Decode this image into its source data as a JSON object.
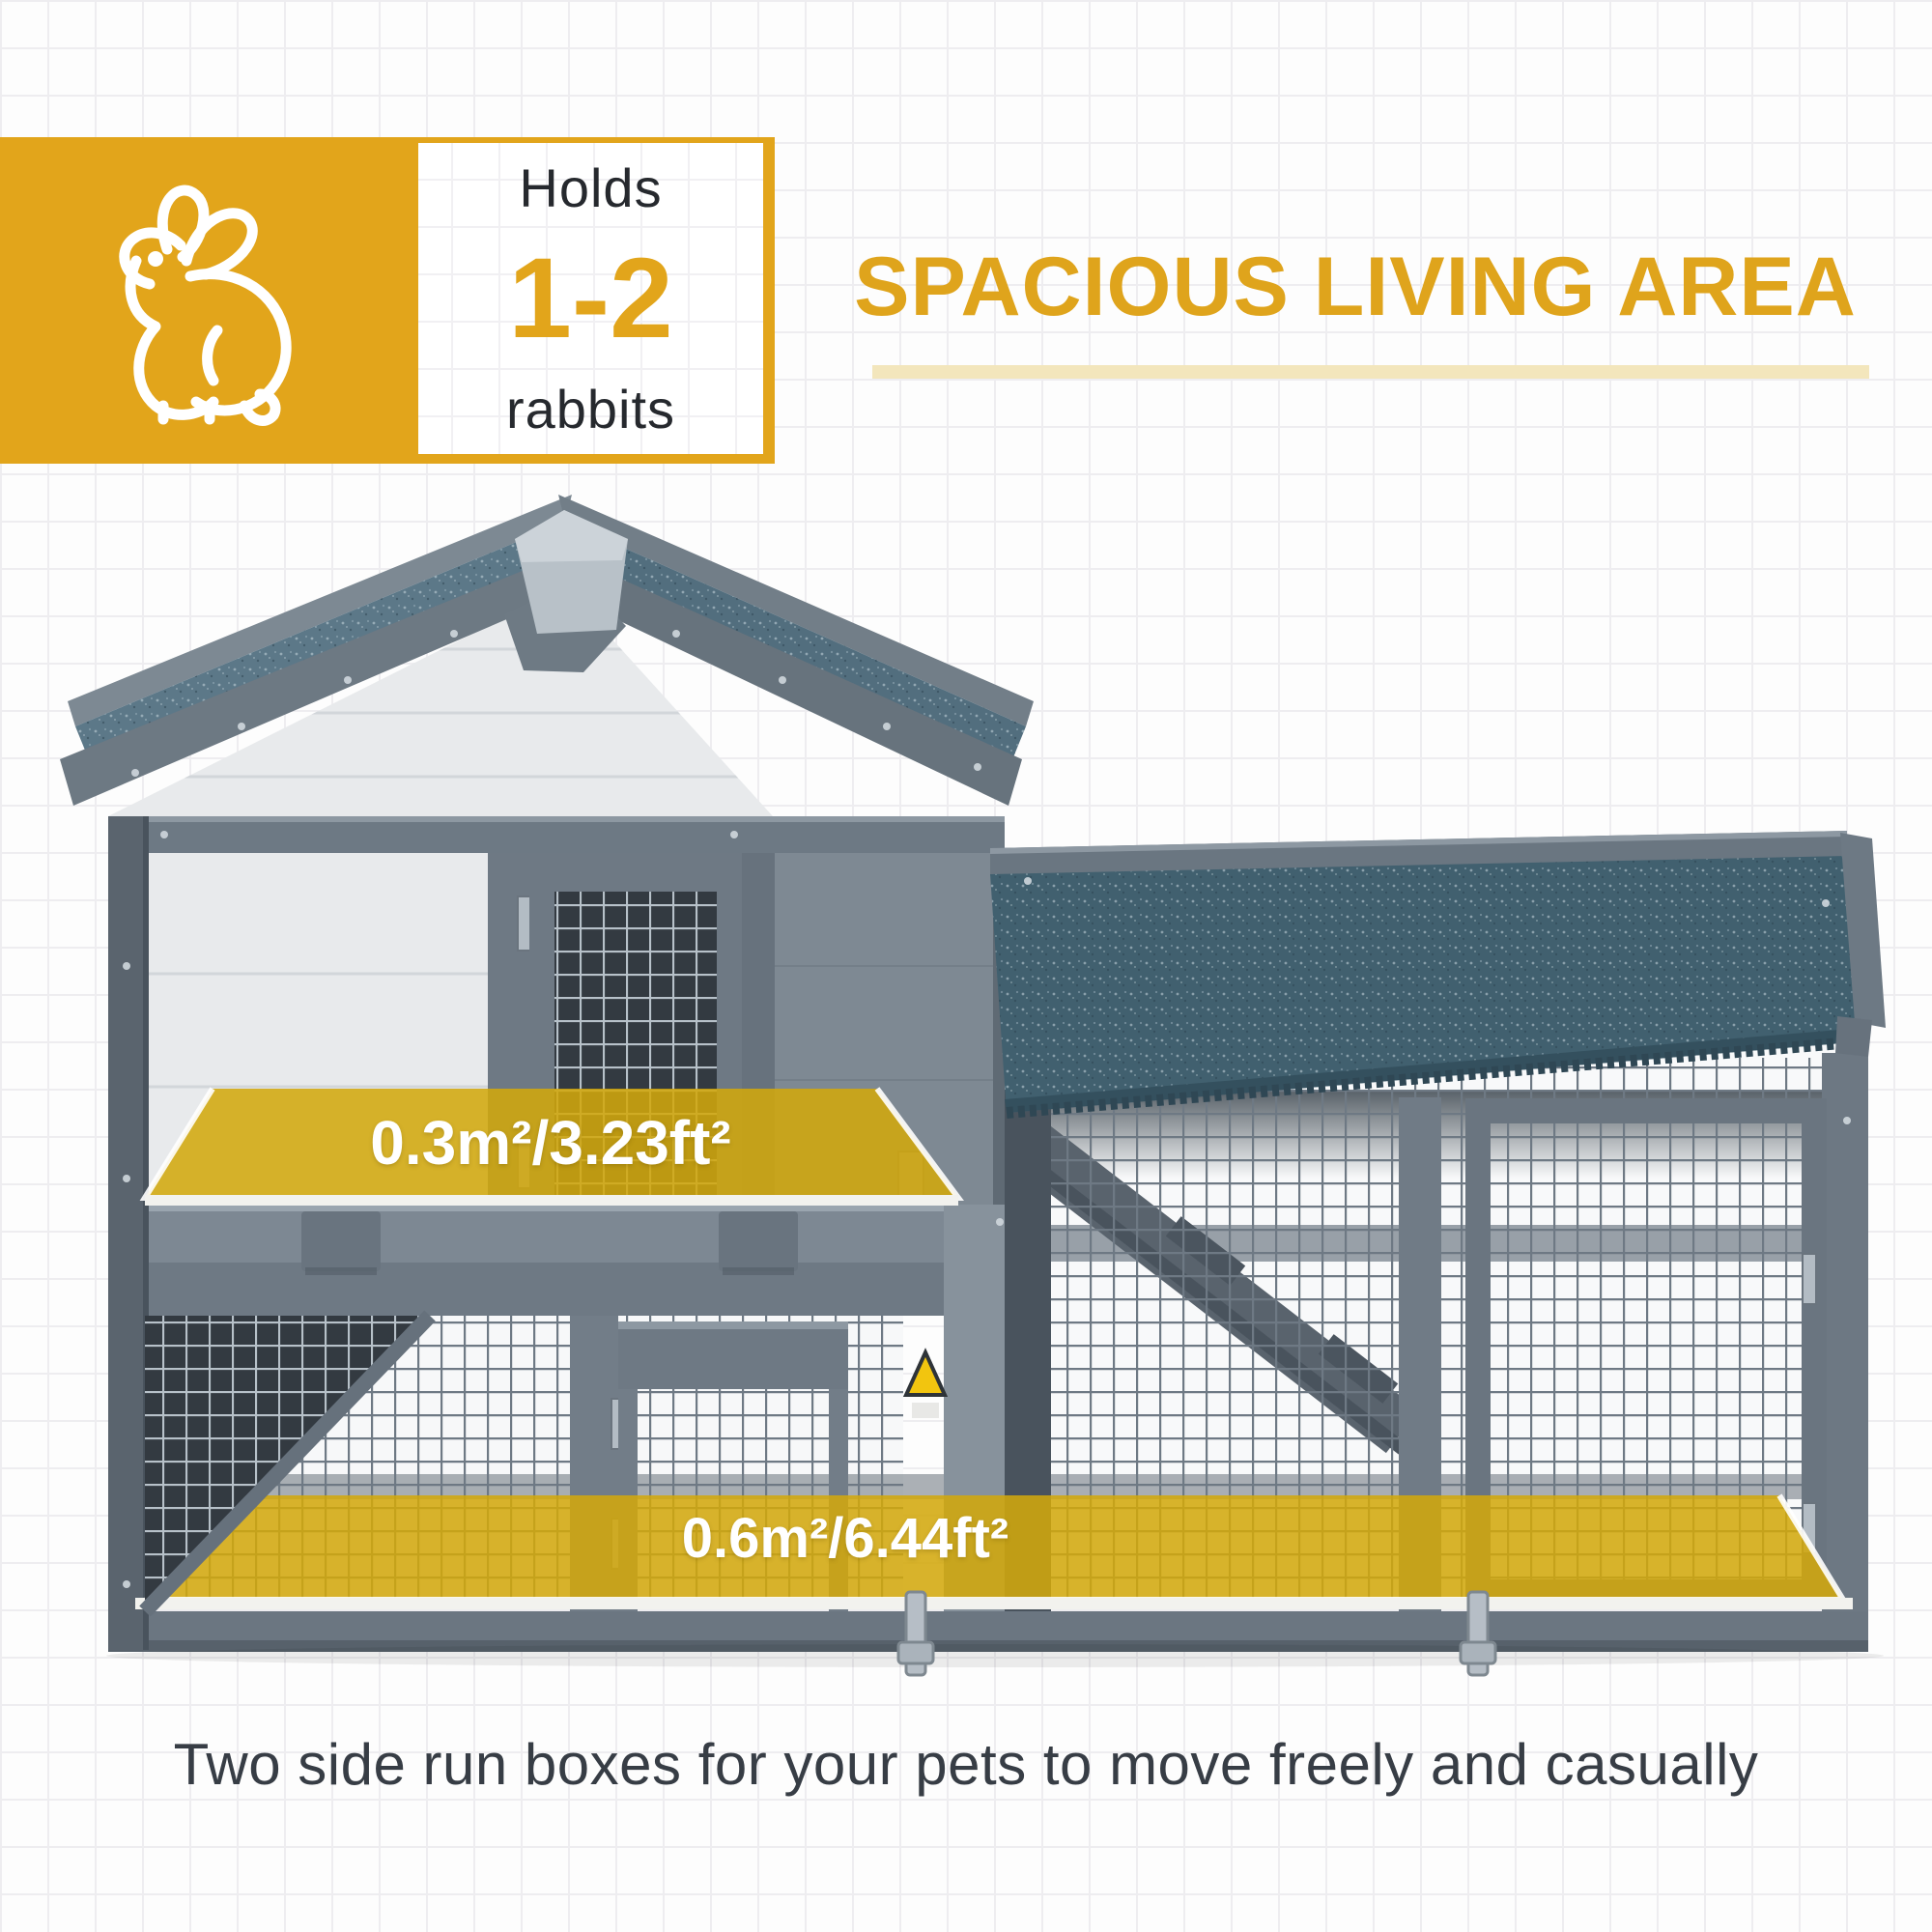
{
  "badge": {
    "holds": "Holds",
    "count": "1-2",
    "animal": "rabbits",
    "bg_color": "#E2A51B",
    "icon": "rabbit-icon"
  },
  "header": {
    "title": "SPACIOUS LIVING AREA",
    "title_color": "#DFA41C",
    "underline_color": "#F3E6BC"
  },
  "hutch": {
    "upper_area_label": "0.3m²/3.23ft²",
    "lower_area_label": "0.6m²/6.44ft²",
    "overlay_color": "#D2A80C",
    "roof_color_main": "#5C7888",
    "roof_color_run": "#41606F",
    "frame_color": "#6E7984",
    "wall_color": "#E8EAEC",
    "ridge_cap_color": "#B8C1C8"
  },
  "caption": {
    "text": "Two side run boxes for your pets to move freely and casually",
    "color": "#373D45"
  }
}
